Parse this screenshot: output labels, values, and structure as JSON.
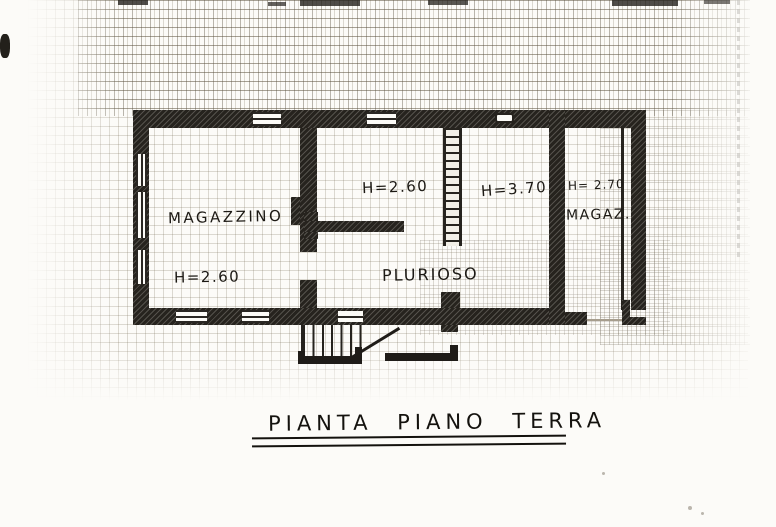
{
  "plan": {
    "caption": "PIANTA PIANO TERRA",
    "room_labels": [
      {
        "text": "MAGAZZINO"
      },
      {
        "text": "PLURIOSO"
      },
      {
        "text": "MAGAZ."
      }
    ],
    "height_annotations": [
      {
        "text": "H=2.60",
        "room": "MAGAZZINO"
      },
      {
        "text": "H=2.60",
        "room": "PLURIOSO"
      },
      {
        "text": "H=3.70",
        "room": "PLURIOSO"
      },
      {
        "text": "H= 2.70",
        "room": "MAGAZ."
      }
    ],
    "colors": {
      "ink": "#26231e",
      "paper": "#fcfbf8",
      "grid": "#7d725c"
    }
  }
}
